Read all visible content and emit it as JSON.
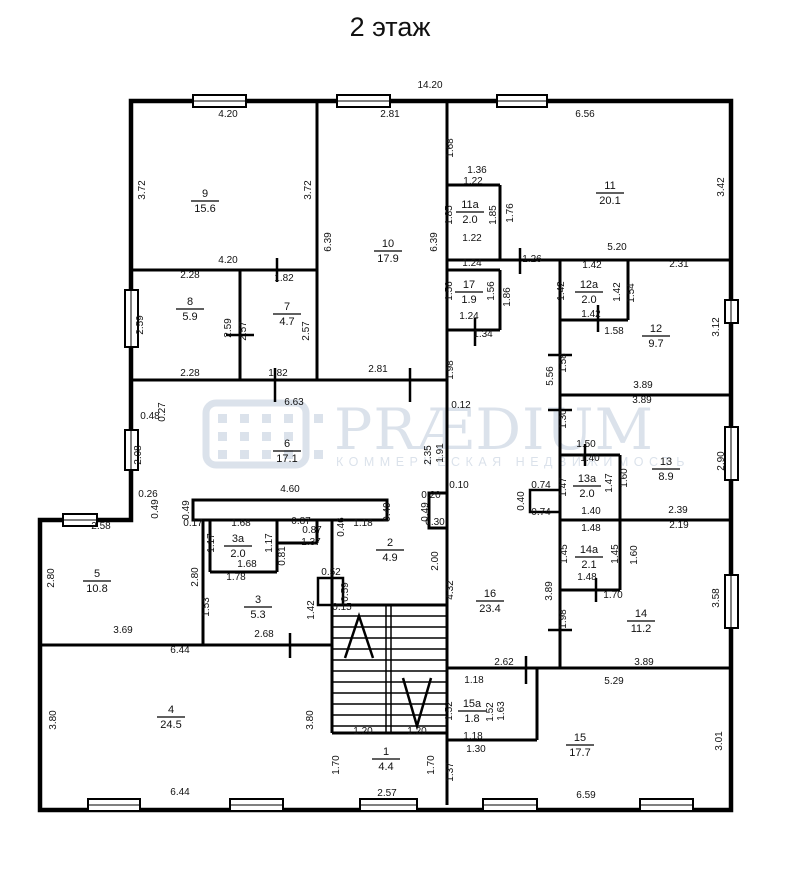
{
  "title": "2 этаж",
  "overall_width": "14.20",
  "watermark": {
    "brand": "PRÆDIUM",
    "subtitle": "КОММЕРЧЕСКАЯ НЕДВИЖИМОСТЬ"
  },
  "rooms": [
    {
      "num": "9",
      "area": "15.6",
      "x": 205,
      "y": 200
    },
    {
      "num": "8",
      "area": "5.9",
      "x": 190,
      "y": 308
    },
    {
      "num": "7",
      "area": "4.7",
      "x": 287,
      "y": 313
    },
    {
      "num": "10",
      "area": "17.9",
      "x": 388,
      "y": 250
    },
    {
      "num": "11",
      "area": "20.1",
      "x": 610,
      "y": 192
    },
    {
      "num": "11a",
      "area": "2.0",
      "x": 470,
      "y": 211
    },
    {
      "num": "17",
      "area": "1.9",
      "x": 469,
      "y": 291
    },
    {
      "num": "12a",
      "area": "2.0",
      "x": 589,
      "y": 291
    },
    {
      "num": "12",
      "area": "9.7",
      "x": 656,
      "y": 335
    },
    {
      "num": "13a",
      "area": "2.0",
      "x": 587,
      "y": 485
    },
    {
      "num": "13",
      "area": "8.9",
      "x": 666,
      "y": 468
    },
    {
      "num": "14a",
      "area": "2.1",
      "x": 589,
      "y": 556
    },
    {
      "num": "14",
      "area": "11.2",
      "x": 641,
      "y": 620
    },
    {
      "num": "16",
      "area": "23.4",
      "x": 490,
      "y": 600
    },
    {
      "num": "15a",
      "area": "1.8",
      "x": 472,
      "y": 710
    },
    {
      "num": "15",
      "area": "17.7",
      "x": 580,
      "y": 744
    },
    {
      "num": "6",
      "area": "17.1",
      "x": 287,
      "y": 450
    },
    {
      "num": "5",
      "area": "10.8",
      "x": 97,
      "y": 580
    },
    {
      "num": "3a",
      "area": "2.0",
      "x": 238,
      "y": 545
    },
    {
      "num": "3",
      "area": "5.3",
      "x": 258,
      "y": 606
    },
    {
      "num": "2",
      "area": "4.9",
      "x": 390,
      "y": 549
    },
    {
      "num": "4",
      "area": "24.5",
      "x": 171,
      "y": 716
    },
    {
      "num": "1",
      "area": "4.4",
      "x": 386,
      "y": 758
    }
  ],
  "dims": [
    {
      "t": "14.20",
      "x": 430,
      "y": 88
    },
    {
      "t": "4.20",
      "x": 228,
      "y": 117
    },
    {
      "t": "3.72",
      "x": 145,
      "y": 190,
      "r": 1
    },
    {
      "t": "3.72",
      "x": 311,
      "y": 190,
      "r": 1
    },
    {
      "t": "4.20",
      "x": 228,
      "y": 263
    },
    {
      "t": "2.28",
      "x": 190,
      "y": 278
    },
    {
      "t": "2.59",
      "x": 143,
      "y": 325,
      "r": 1
    },
    {
      "t": "2.59",
      "x": 231,
      "y": 328,
      "r": 1
    },
    {
      "t": "2.28",
      "x": 190,
      "y": 376
    },
    {
      "t": "1.82",
      "x": 284,
      "y": 281
    },
    {
      "t": "2.57",
      "x": 246,
      "y": 331,
      "r": 1
    },
    {
      "t": "2.57",
      "x": 309,
      "y": 331,
      "r": 1
    },
    {
      "t": "1.82",
      "x": 278,
      "y": 376
    },
    {
      "t": "2.81",
      "x": 390,
      "y": 117
    },
    {
      "t": "6.39",
      "x": 331,
      "y": 242,
      "r": 1
    },
    {
      "t": "6.39",
      "x": 437,
      "y": 242,
      "r": 1
    },
    {
      "t": "2.81",
      "x": 378,
      "y": 372
    },
    {
      "t": "6.56",
      "x": 585,
      "y": 117
    },
    {
      "t": "1.68",
      "x": 453,
      "y": 148,
      "r": 1
    },
    {
      "t": "1.36",
      "x": 477,
      "y": 173
    },
    {
      "t": "3.42",
      "x": 724,
      "y": 187,
      "r": 1
    },
    {
      "t": "5.20",
      "x": 617,
      "y": 250
    },
    {
      "t": "1.22",
      "x": 473,
      "y": 184
    },
    {
      "t": "1.85",
      "x": 452,
      "y": 215,
      "r": 1
    },
    {
      "t": "1.85",
      "x": 496,
      "y": 215,
      "r": 1
    },
    {
      "t": "1.76",
      "x": 513,
      "y": 213,
      "r": 1
    },
    {
      "t": "1.22",
      "x": 472,
      "y": 241
    },
    {
      "t": "1.24",
      "x": 472,
      "y": 266
    },
    {
      "t": "1.56",
      "x": 452,
      "y": 291,
      "r": 1
    },
    {
      "t": "1.56",
      "x": 494,
      "y": 291,
      "r": 1
    },
    {
      "t": "1.86",
      "x": 510,
      "y": 297,
      "r": 1
    },
    {
      "t": "1.24",
      "x": 469,
      "y": 319
    },
    {
      "t": "1.34",
      "x": 483,
      "y": 337
    },
    {
      "t": "1.26",
      "x": 532,
      "y": 262
    },
    {
      "t": "1.98",
      "x": 453,
      "y": 370,
      "r": 1
    },
    {
      "t": "0.12",
      "x": 461,
      "y": 408
    },
    {
      "t": "2.35",
      "x": 431,
      "y": 455,
      "r": 1
    },
    {
      "t": "1.91",
      "x": 443,
      "y": 453,
      "r": 1
    },
    {
      "t": "0.10",
      "x": 459,
      "y": 488
    },
    {
      "t": "0.20",
      "x": 431,
      "y": 498
    },
    {
      "t": "0.49",
      "x": 428,
      "y": 512,
      "r": 1
    },
    {
      "t": "0.30",
      "x": 435,
      "y": 525
    },
    {
      "t": "6.63",
      "x": 294,
      "y": 405
    },
    {
      "t": "0.48",
      "x": 150,
      "y": 419
    },
    {
      "t": "0.27",
      "x": 165,
      "y": 412,
      "r": 1
    },
    {
      "t": "2.08",
      "x": 141,
      "y": 455,
      "r": 1
    },
    {
      "t": "0.26",
      "x": 148,
      "y": 497
    },
    {
      "t": "0.49",
      "x": 158,
      "y": 509,
      "r": 1
    },
    {
      "t": "4.60",
      "x": 290,
      "y": 492
    },
    {
      "t": "0.49",
      "x": 189,
      "y": 510,
      "r": 1
    },
    {
      "t": "0.49",
      "x": 390,
      "y": 512,
      "r": 1
    },
    {
      "t": "0.17",
      "x": 193,
      "y": 526
    },
    {
      "t": "1.68",
      "x": 241,
      "y": 526
    },
    {
      "t": "0.87",
      "x": 301,
      "y": 524
    },
    {
      "t": "0.87",
      "x": 312,
      "y": 533
    },
    {
      "t": "1.37",
      "x": 311,
      "y": 545
    },
    {
      "t": "0.81",
      "x": 285,
      "y": 556,
      "r": 1
    },
    {
      "t": "0.46",
      "x": 344,
      "y": 527,
      "r": 1
    },
    {
      "t": "1.18",
      "x": 363,
      "y": 526
    },
    {
      "t": "1.17",
      "x": 214,
      "y": 543,
      "r": 1
    },
    {
      "t": "1.17",
      "x": 272,
      "y": 543,
      "r": 1
    },
    {
      "t": "1.68",
      "x": 247,
      "y": 567
    },
    {
      "t": "1.78",
      "x": 236,
      "y": 580
    },
    {
      "t": "1.53",
      "x": 209,
      "y": 607,
      "r": 1
    },
    {
      "t": "2.80",
      "x": 198,
      "y": 577,
      "r": 1
    },
    {
      "t": "2.68",
      "x": 264,
      "y": 637
    },
    {
      "t": "1.42",
      "x": 314,
      "y": 610,
      "r": 1
    },
    {
      "t": "0.52",
      "x": 331,
      "y": 575
    },
    {
      "t": "0.59",
      "x": 348,
      "y": 592,
      "r": 1
    },
    {
      "t": "0.15",
      "x": 342,
      "y": 610
    },
    {
      "t": "2.58",
      "x": 101,
      "y": 529
    },
    {
      "t": "2.80",
      "x": 54,
      "y": 578,
      "r": 1
    },
    {
      "t": "3.69",
      "x": 123,
      "y": 633
    },
    {
      "t": "6.44",
      "x": 180,
      "y": 653
    },
    {
      "t": "3.80",
      "x": 56,
      "y": 720,
      "r": 1
    },
    {
      "t": "3.80",
      "x": 313,
      "y": 720,
      "r": 1
    },
    {
      "t": "6.44",
      "x": 180,
      "y": 795
    },
    {
      "t": "2.00",
      "x": 438,
      "y": 561,
      "r": 1
    },
    {
      "t": "4.32",
      "x": 453,
      "y": 590,
      "r": 1
    },
    {
      "t": "1.20",
      "x": 363,
      "y": 734
    },
    {
      "t": "1.20",
      "x": 417,
      "y": 734
    },
    {
      "t": "1.70",
      "x": 339,
      "y": 765,
      "r": 1
    },
    {
      "t": "1.70",
      "x": 434,
      "y": 765,
      "r": 1
    },
    {
      "t": "2.57",
      "x": 387,
      "y": 796
    },
    {
      "t": "2.62",
      "x": 504,
      "y": 665
    },
    {
      "t": "0.74",
      "x": 541,
      "y": 488
    },
    {
      "t": "0.40",
      "x": 524,
      "y": 501,
      "r": 1
    },
    {
      "t": "0.74",
      "x": 541,
      "y": 515
    },
    {
      "t": "5.56",
      "x": 553,
      "y": 376,
      "r": 1
    },
    {
      "t": "1.58",
      "x": 566,
      "y": 363,
      "r": 1
    },
    {
      "t": "1.30",
      "x": 566,
      "y": 419,
      "r": 1
    },
    {
      "t": "3.89",
      "x": 552,
      "y": 591,
      "r": 1
    },
    {
      "t": "1.98",
      "x": 566,
      "y": 619,
      "r": 1
    },
    {
      "t": "1.42",
      "x": 592,
      "y": 268
    },
    {
      "t": "12a-left",
      "x": 0,
      "y": 0
    },
    {
      "t": "1.42",
      "x": 564,
      "y": 291,
      "r": 1
    },
    {
      "t": "1.42",
      "x": 620,
      "y": 292,
      "r": 1
    },
    {
      "t": "1.54",
      "x": 634,
      "y": 293,
      "r": 1
    },
    {
      "t": "1.42",
      "x": 591,
      "y": 317
    },
    {
      "t": "1.58",
      "x": 614,
      "y": 334
    },
    {
      "t": "2.31",
      "x": 679,
      "y": 267
    },
    {
      "t": "3.12",
      "x": 719,
      "y": 327,
      "r": 1
    },
    {
      "t": "3.89",
      "x": 643,
      "y": 388
    },
    {
      "t": "3.89",
      "x": 642,
      "y": 403
    },
    {
      "t": "1.50",
      "x": 586,
      "y": 447
    },
    {
      "t": "1.40",
      "x": 590,
      "y": 461
    },
    {
      "t": "1.47",
      "x": 566,
      "y": 487,
      "r": 1
    },
    {
      "t": "1.47",
      "x": 612,
      "y": 483,
      "r": 1
    },
    {
      "t": "1.60",
      "x": 627,
      "y": 478,
      "r": 1
    },
    {
      "t": "2.90",
      "x": 724,
      "y": 461,
      "r": 1
    },
    {
      "t": "1.40",
      "x": 591,
      "y": 514
    },
    {
      "t": "2.39",
      "x": 678,
      "y": 513
    },
    {
      "t": "1.48",
      "x": 591,
      "y": 531
    },
    {
      "t": "1.45",
      "x": 567,
      "y": 554,
      "r": 1
    },
    {
      "t": "1.45",
      "x": 618,
      "y": 554,
      "r": 1
    },
    {
      "t": "1.60",
      "x": 637,
      "y": 555,
      "r": 1
    },
    {
      "t": "2.19",
      "x": 679,
      "y": 528
    },
    {
      "t": "1.48",
      "x": 587,
      "y": 580
    },
    {
      "t": "1.70",
      "x": 613,
      "y": 598
    },
    {
      "t": "3.58",
      "x": 719,
      "y": 598,
      "r": 1
    },
    {
      "t": "3.89",
      "x": 644,
      "y": 665
    },
    {
      "t": "5.29",
      "x": 614,
      "y": 684
    },
    {
      "t": "1.18",
      "x": 474,
      "y": 683
    },
    {
      "t": "1.52",
      "x": 452,
      "y": 711,
      "r": 1
    },
    {
      "t": "1.52",
      "x": 493,
      "y": 712,
      "r": 1
    },
    {
      "t": "1.63",
      "x": 504,
      "y": 711,
      "r": 1
    },
    {
      "t": "1.18",
      "x": 473,
      "y": 739
    },
    {
      "t": "1.30",
      "x": 476,
      "y": 752
    },
    {
      "t": "1.37",
      "x": 453,
      "y": 772,
      "r": 1
    },
    {
      "t": "3.01",
      "x": 722,
      "y": 741,
      "r": 1
    },
    {
      "t": "6.59",
      "x": 586,
      "y": 798
    }
  ]
}
